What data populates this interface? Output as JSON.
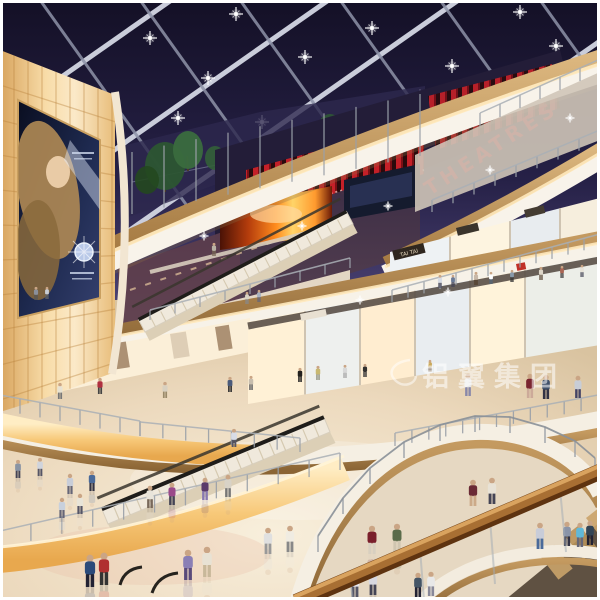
{
  "image": {
    "type": "architectural rendering",
    "subject": "multi-level shopping mall atrium at night with glass skylight, curved balconies, escalators and shoppers",
    "width": 600,
    "height": 600
  },
  "signs": {
    "theatres": "THEATRES",
    "tai_tai": "TAI TAI"
  },
  "watermark": {
    "text": "铝翼集团"
  },
  "palette": {
    "sky": "#1a1533",
    "beam": "#d4d7e4",
    "wood": "#c79d62",
    "soffit": "#f8f3ea",
    "glow_wall": "#f6d9a4",
    "theatre_red": "#c1121f",
    "fire_screen": "#ff8c1e",
    "floor": "#eeddc2",
    "handrail": "#a86f33"
  },
  "scene": {
    "decor": {
      "beams_main": [
        [
          0,
          120,
          260,
          -62
        ],
        [
          0,
          230,
          420,
          -64
        ],
        [
          30,
          300,
          550,
          -64
        ],
        [
          230,
          300,
          600,
          41
        ],
        [
          430,
          300,
          600,
          181
        ]
      ],
      "beams_cross": [
        [
          -60,
          0,
          170,
          322
        ],
        [
          40,
          0,
          270,
          322
        ],
        [
          140,
          0,
          370,
          322
        ],
        [
          240,
          0,
          470,
          322
        ],
        [
          340,
          0,
          570,
          322
        ],
        [
          440,
          0,
          670,
          322
        ],
        [
          540,
          0,
          770,
          322
        ]
      ],
      "skylight_lights": [
        [
          150,
          38
        ],
        [
          236,
          14
        ],
        [
          305,
          57
        ],
        [
          372,
          28
        ],
        [
          452,
          66
        ],
        [
          520,
          12
        ],
        [
          556,
          46
        ],
        [
          492,
          104
        ],
        [
          420,
          96
        ],
        [
          208,
          78
        ],
        [
          560,
          92
        ],
        [
          352,
          118
        ],
        [
          262,
          122
        ],
        [
          178,
          118
        ]
      ],
      "sparkles": [
        [
          204,
          236
        ],
        [
          302,
          226
        ],
        [
          388,
          206
        ],
        [
          490,
          170
        ],
        [
          570,
          118
        ],
        [
          448,
          292
        ],
        [
          360,
          300
        ]
      ],
      "posts": [
        {
          "x1": 0,
          "y1": 410,
          "x2": 140,
          "y2": 436,
          "n": 8,
          "h": 15
        },
        {
          "x1": 140,
          "y1": 436,
          "x2": 300,
          "y2": 452,
          "n": 8,
          "h": 14
        },
        {
          "x1": 395,
          "y1": 446,
          "x2": 598,
          "y2": 408,
          "n": 13,
          "h": 13
        },
        {
          "x1": 392,
          "y1": 302,
          "x2": 600,
          "y2": 246,
          "n": 14,
          "h": 12
        },
        {
          "x1": 0,
          "y1": 548,
          "x2": 340,
          "y2": 470,
          "n": 12,
          "h": 17
        },
        {
          "x1": 480,
          "y1": 126,
          "x2": 600,
          "y2": 72,
          "n": 7,
          "h": 13
        },
        {
          "x1": 432,
          "y1": 212,
          "x2": 600,
          "y2": 142,
          "n": 9,
          "h": 12
        },
        {
          "x1": 132,
          "y1": 152,
          "x2": 420,
          "y2": 94,
          "n": 10,
          "h": 62,
          "d": 1
        },
        {
          "x1": 150,
          "y1": 320,
          "x2": 350,
          "y2": 268,
          "n": 9,
          "h": 10
        }
      ],
      "arc_posts": {
        "h": 16,
        "points": [
          [
            318,
            552
          ],
          [
            343,
            514
          ],
          [
            370,
            484
          ],
          [
            404,
            458
          ],
          [
            440,
            441
          ],
          [
            475,
            432
          ],
          [
            510,
            433
          ],
          [
            545,
            443
          ],
          [
            575,
            457
          ],
          [
            595,
            474
          ]
        ]
      },
      "ticks": [
        {
          "x1": 145,
          "y1": 332,
          "x2": 353,
          "y2": 224,
          "n": 20,
          "dx": -5,
          "dy": -9.7,
          "color": "#cfc2a6",
          "w": 1.1
        },
        {
          "x1": 108,
          "y1": 524,
          "x2": 330,
          "y2": 432,
          "n": 20,
          "dx": -5,
          "dy": -12,
          "color": "#cfc2a6",
          "w": 1.2
        }
      ]
    },
    "people": [
      [
        36,
        300,
        13,
        "#8a8f9a",
        "#555555",
        0
      ],
      [
        47,
        299,
        12,
        "#c8ccd4",
        "#666666",
        0
      ],
      [
        214,
        256,
        13,
        "#b8b2a4",
        "#776655",
        0
      ],
      [
        247,
        304,
        12,
        "#d8d2c4",
        "#888888",
        0
      ],
      [
        259,
        302,
        12,
        "#a8b2c0",
        "#666677",
        0
      ],
      [
        440,
        288,
        13,
        "#d8dce4",
        "#555566",
        0
      ],
      [
        453,
        287,
        12,
        "#6a7a96",
        "#444455",
        0
      ],
      [
        476,
        285,
        13,
        "#c8b8a8",
        "#55402f",
        0
      ],
      [
        491,
        284,
        12,
        "#ffffff",
        "#556677",
        0
      ],
      [
        512,
        282,
        12,
        "#8899aa",
        "#333333",
        0
      ],
      [
        541,
        280,
        13,
        "#ddd6c8",
        "#665544",
        0
      ],
      [
        562,
        278,
        12,
        "#aa6655",
        "#444444",
        0
      ],
      [
        582,
        277,
        12,
        "#e8e4da",
        "#555566",
        0
      ],
      [
        60,
        399,
        16,
        "#e8e2d2",
        "#777777",
        0
      ],
      [
        100,
        394,
        16,
        "#b03040",
        "#444444",
        0
      ],
      [
        165,
        398,
        16,
        "#d8d0c0",
        "#9a8a6a",
        0
      ],
      [
        230,
        392,
        15,
        "#4a5a7a",
        "#333333",
        0
      ],
      [
        251,
        390,
        14,
        "#c8beae",
        "#666666",
        0
      ],
      [
        468,
        396,
        22,
        "#e8e8e8",
        "#8888aa",
        0
      ],
      [
        530,
        398,
        24,
        "#7a2530",
        "#ccaa99",
        0
      ],
      [
        546,
        399,
        24,
        "#40506a",
        "#333344",
        0
      ],
      [
        578,
        398,
        22,
        "#c8cdd6",
        "#444466",
        0
      ],
      [
        300,
        382,
        14,
        "#22201e",
        "#222222",
        0
      ],
      [
        318,
        380,
        14,
        "#c8b870",
        "#999988",
        0
      ],
      [
        345,
        378,
        13,
        "#d8d8d8",
        "#aaaaaa",
        0
      ],
      [
        365,
        377,
        13,
        "#33312f",
        "#333333",
        0
      ],
      [
        430,
        372,
        12,
        "#caa85a",
        "#998877",
        0
      ],
      [
        18,
        478,
        18,
        "#8a94a4",
        "#444455",
        1
      ],
      [
        40,
        476,
        18,
        "#d0d4dc",
        "#555566",
        1
      ],
      [
        70,
        494,
        20,
        "#c8cdd8",
        "#666677",
        1
      ],
      [
        92,
        491,
        20,
        "#4a6a9a",
        "#333344",
        1
      ],
      [
        150,
        508,
        22,
        "#e8e4da",
        "#78685a",
        1
      ],
      [
        172,
        505,
        22,
        "#9a4a8a",
        "#444455",
        1
      ],
      [
        205,
        500,
        22,
        "#5a3a6a",
        "#8878b0",
        1
      ],
      [
        228,
        497,
        22,
        "#d8d2c6",
        "#777777",
        1
      ],
      [
        268,
        554,
        26,
        "#e0e0e0",
        "#999999",
        1
      ],
      [
        290,
        552,
        26,
        "#f0ece2",
        "#888888",
        1
      ],
      [
        372,
        554,
        28,
        "#7a1f2b",
        "#d8cfc0",
        1
      ],
      [
        397,
        552,
        28,
        "#5a6b4a",
        "#cfc5b0",
        1
      ],
      [
        188,
        580,
        30,
        "#8a7fb5",
        "#5a4a7a",
        1
      ],
      [
        207,
        577,
        30,
        "#e8e2d4",
        "#c8b89a",
        1
      ],
      [
        90,
        587,
        32,
        "#2b4a7a",
        "#222233",
        1
      ],
      [
        104,
        585,
        32,
        "#b03030",
        "#333333",
        1
      ],
      [
        355,
        597,
        26,
        "#e8e8f0",
        "#555566",
        1
      ],
      [
        373,
        595,
        26,
        "#d8d8e0",
        "#444455",
        1
      ],
      [
        234,
        447,
        18,
        "#d8dce6",
        "#555566",
        0
      ],
      [
        62,
        518,
        20,
        "#c8d0dc",
        "#666677",
        1
      ],
      [
        80,
        514,
        20,
        "#e8e4d8",
        "#555566",
        1
      ],
      [
        473,
        506,
        26,
        "#6a2a35",
        "#ccaa88",
        0
      ],
      [
        492,
        504,
        26,
        "#e8e2d6",
        "#444455",
        0
      ],
      [
        540,
        549,
        26,
        "#c8ccd8",
        "#4a6a9a",
        0
      ],
      [
        567,
        546,
        24,
        "#8a94a8",
        "#333344",
        0
      ],
      [
        580,
        547,
        24,
        "#60b8d8",
        "#666677",
        0
      ],
      [
        590,
        545,
        24,
        "#334455",
        "#222233",
        0
      ],
      [
        418,
        597,
        24,
        "#445566",
        "#222233",
        0
      ],
      [
        431,
        596,
        24,
        "#e8e8e8",
        "#888899",
        0
      ]
    ]
  }
}
